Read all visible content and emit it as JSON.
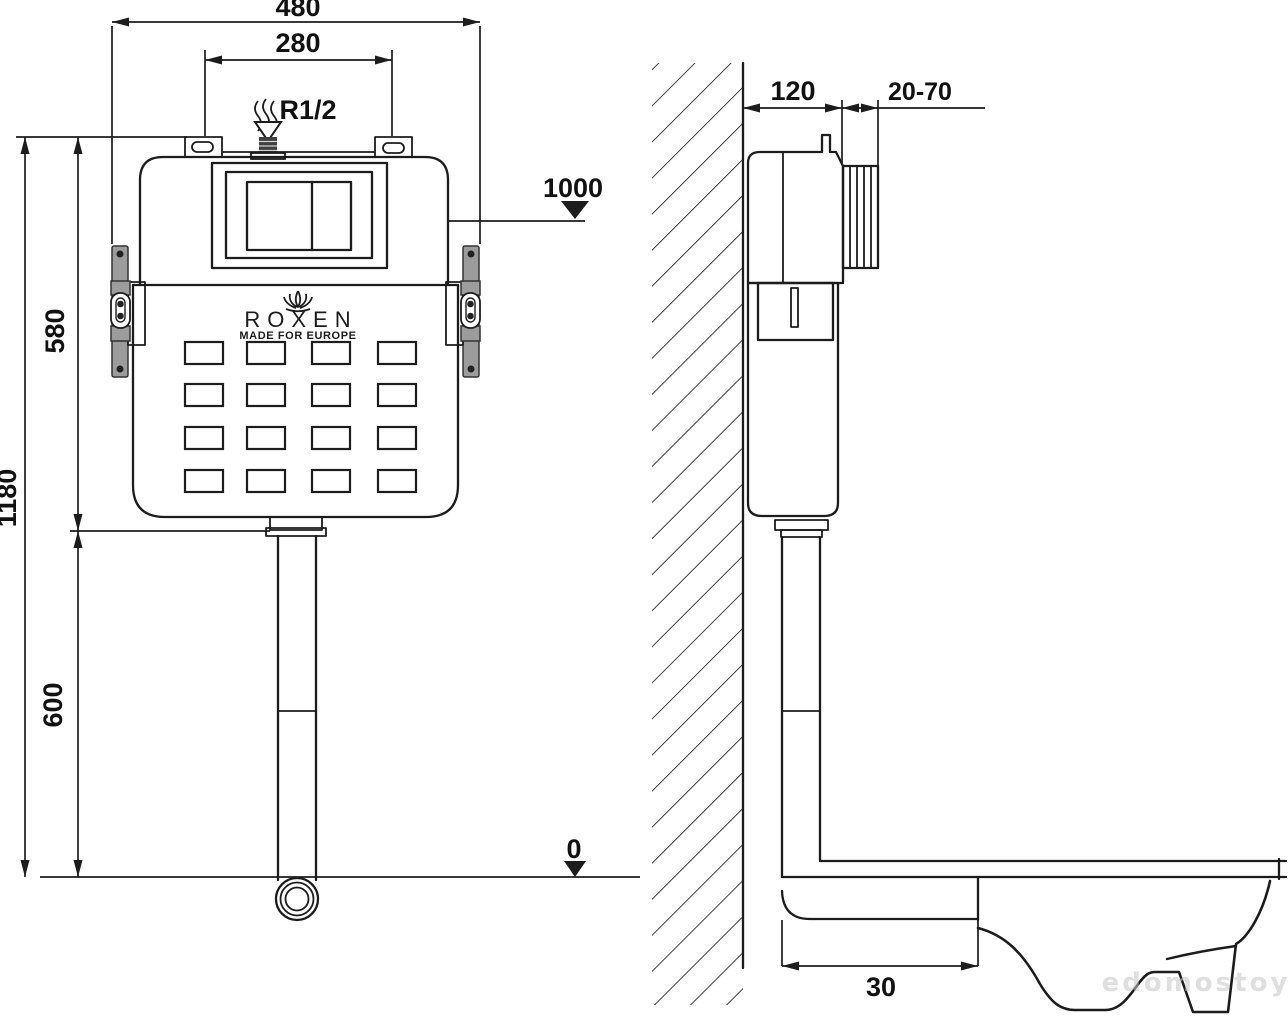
{
  "meta": {
    "description": "Technical installation drawing of a ROXEN concealed WC cistern, front view and side view with dimensions in mm"
  },
  "brand": {
    "logo_text": "ROXEN",
    "tagline": "MADE FOR EUROPE"
  },
  "front_view": {
    "dim_overall_width": "480",
    "dim_bolt_spacing": "280",
    "inlet_thread": "R1/2",
    "dim_overall_height": "1180",
    "dim_tank_height": "580",
    "dim_below_tank": "600",
    "level_button_panel": "1000",
    "level_floor": "0"
  },
  "side_view": {
    "dim_frame_depth": "120",
    "dim_panel_adjust": "20-70",
    "dim_drain_offset": "30"
  },
  "watermark": {
    "text": "edomostoy"
  },
  "colors": {
    "line": "#1c1c1c",
    "bracket_fill": "#9c9c9c",
    "background": "#ffffff",
    "watermark": "#c6c6c6"
  }
}
